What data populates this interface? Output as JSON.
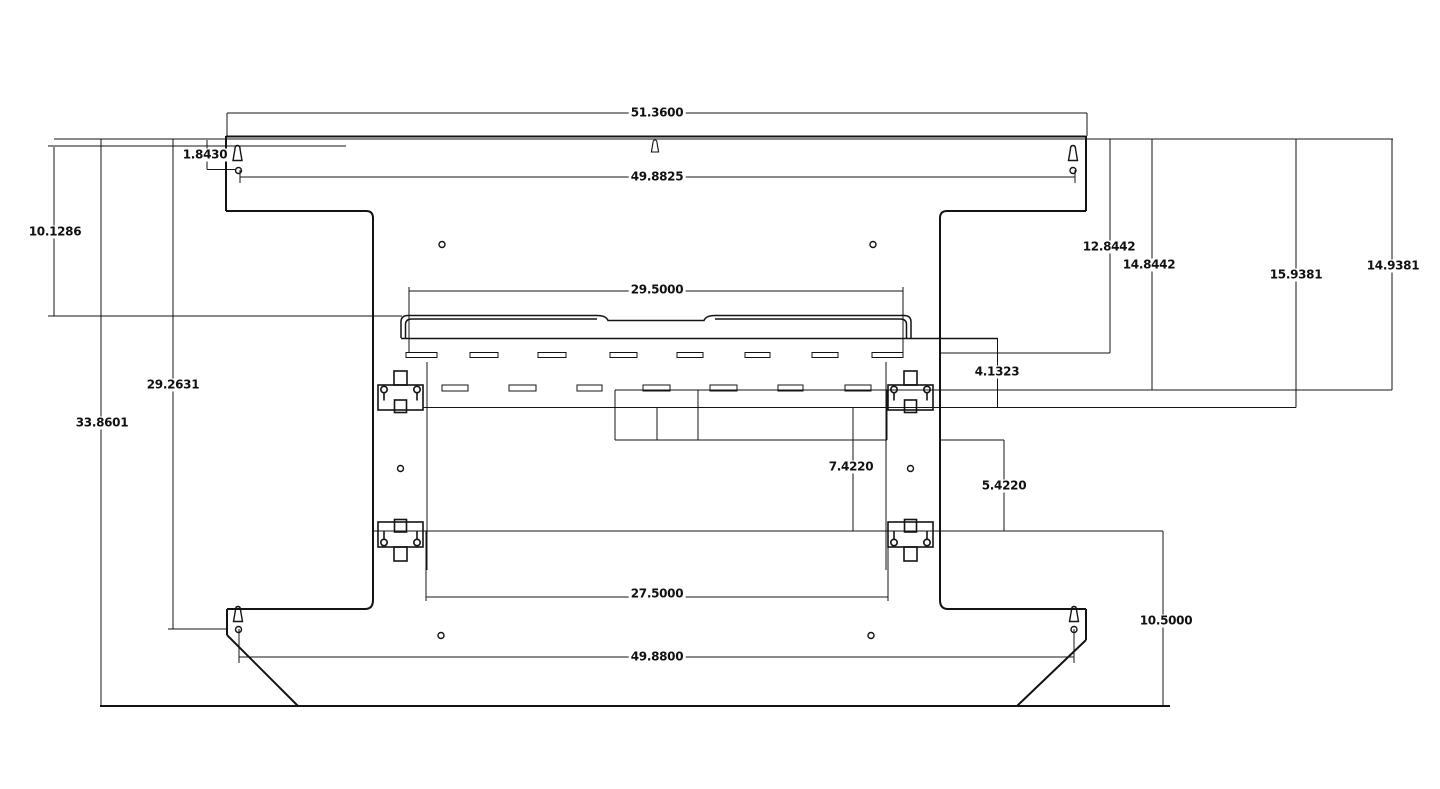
{
  "drawing": {
    "type": "engineering-dimension-drawing",
    "line_color": "#141414",
    "paper_color": "#ffffff",
    "dims": [
      {
        "id": "overall-width-top",
        "value": "51.3600"
      },
      {
        "id": "corner-hole-offset",
        "value": "1.8430"
      },
      {
        "id": "upper-hole-span",
        "value": "49.8825"
      },
      {
        "id": "upper-left-height",
        "value": "10.1286"
      },
      {
        "id": "right-depth-1",
        "value": "12.8442"
      },
      {
        "id": "right-depth-2",
        "value": "14.8442"
      },
      {
        "id": "right-depth-3",
        "value": "15.9381"
      },
      {
        "id": "right-depth-4",
        "value": "14.9381"
      },
      {
        "id": "crossbar-width",
        "value": "29.5000"
      },
      {
        "id": "bracket-drop",
        "value": "4.1323"
      },
      {
        "id": "left-depth-2",
        "value": "29.2631"
      },
      {
        "id": "left-depth-3",
        "value": "33.8601"
      },
      {
        "id": "center-drop-1",
        "value": "7.4220"
      },
      {
        "id": "center-drop-2",
        "value": "5.4220"
      },
      {
        "id": "clamp-rail-span",
        "value": "27.5000"
      },
      {
        "id": "lower-right-height",
        "value": "10.5000"
      },
      {
        "id": "lower-hole-span",
        "value": "49.8800"
      }
    ]
  }
}
